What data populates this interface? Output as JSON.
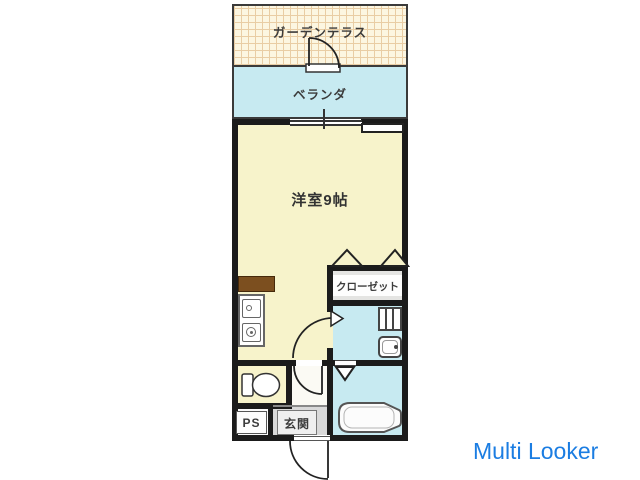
{
  "page": {
    "width": 640,
    "height": 480,
    "background": "#ffffff"
  },
  "watermark": {
    "text": "Multi Looker",
    "color": "#1b7de2"
  },
  "floorplan": {
    "type": "apartment-floor-plan",
    "rooms": {
      "garden_terrace": {
        "label": "ガーデンテラス"
      },
      "veranda": {
        "label": "ベランダ"
      },
      "main_room": {
        "label": "洋室9帖",
        "size_tatami": 9
      },
      "closet": {
        "label": "クローゼット"
      },
      "entrance": {
        "label": "玄関"
      },
      "pipe_space": {
        "label": "PS"
      }
    },
    "fixtures": [
      "terrace-door-swing",
      "balcony-sliding-window",
      "window-sill",
      "kitchen-counter",
      "kitchen-sink",
      "gas-stove",
      "closet-folding-doors",
      "washroom-door-swing",
      "washing-machine-pan",
      "washbasin",
      "hall-door-swing",
      "toilet",
      "bathtub",
      "bathroom-folding-door",
      "entrance-door-swing"
    ],
    "colors": {
      "wall": "#1b1b1b",
      "room_yellow": "#f7f3cb",
      "water_cyan": "#c7eaf1",
      "terrace_cream": "#fcf6e1",
      "terrace_grid": "#e9cda4",
      "counter_brown": "#7c4f1f",
      "entrance_gray": "#d9d9d9",
      "closet_white": "#f2f2f0",
      "watermark_blue": "#1b7de2"
    }
  }
}
